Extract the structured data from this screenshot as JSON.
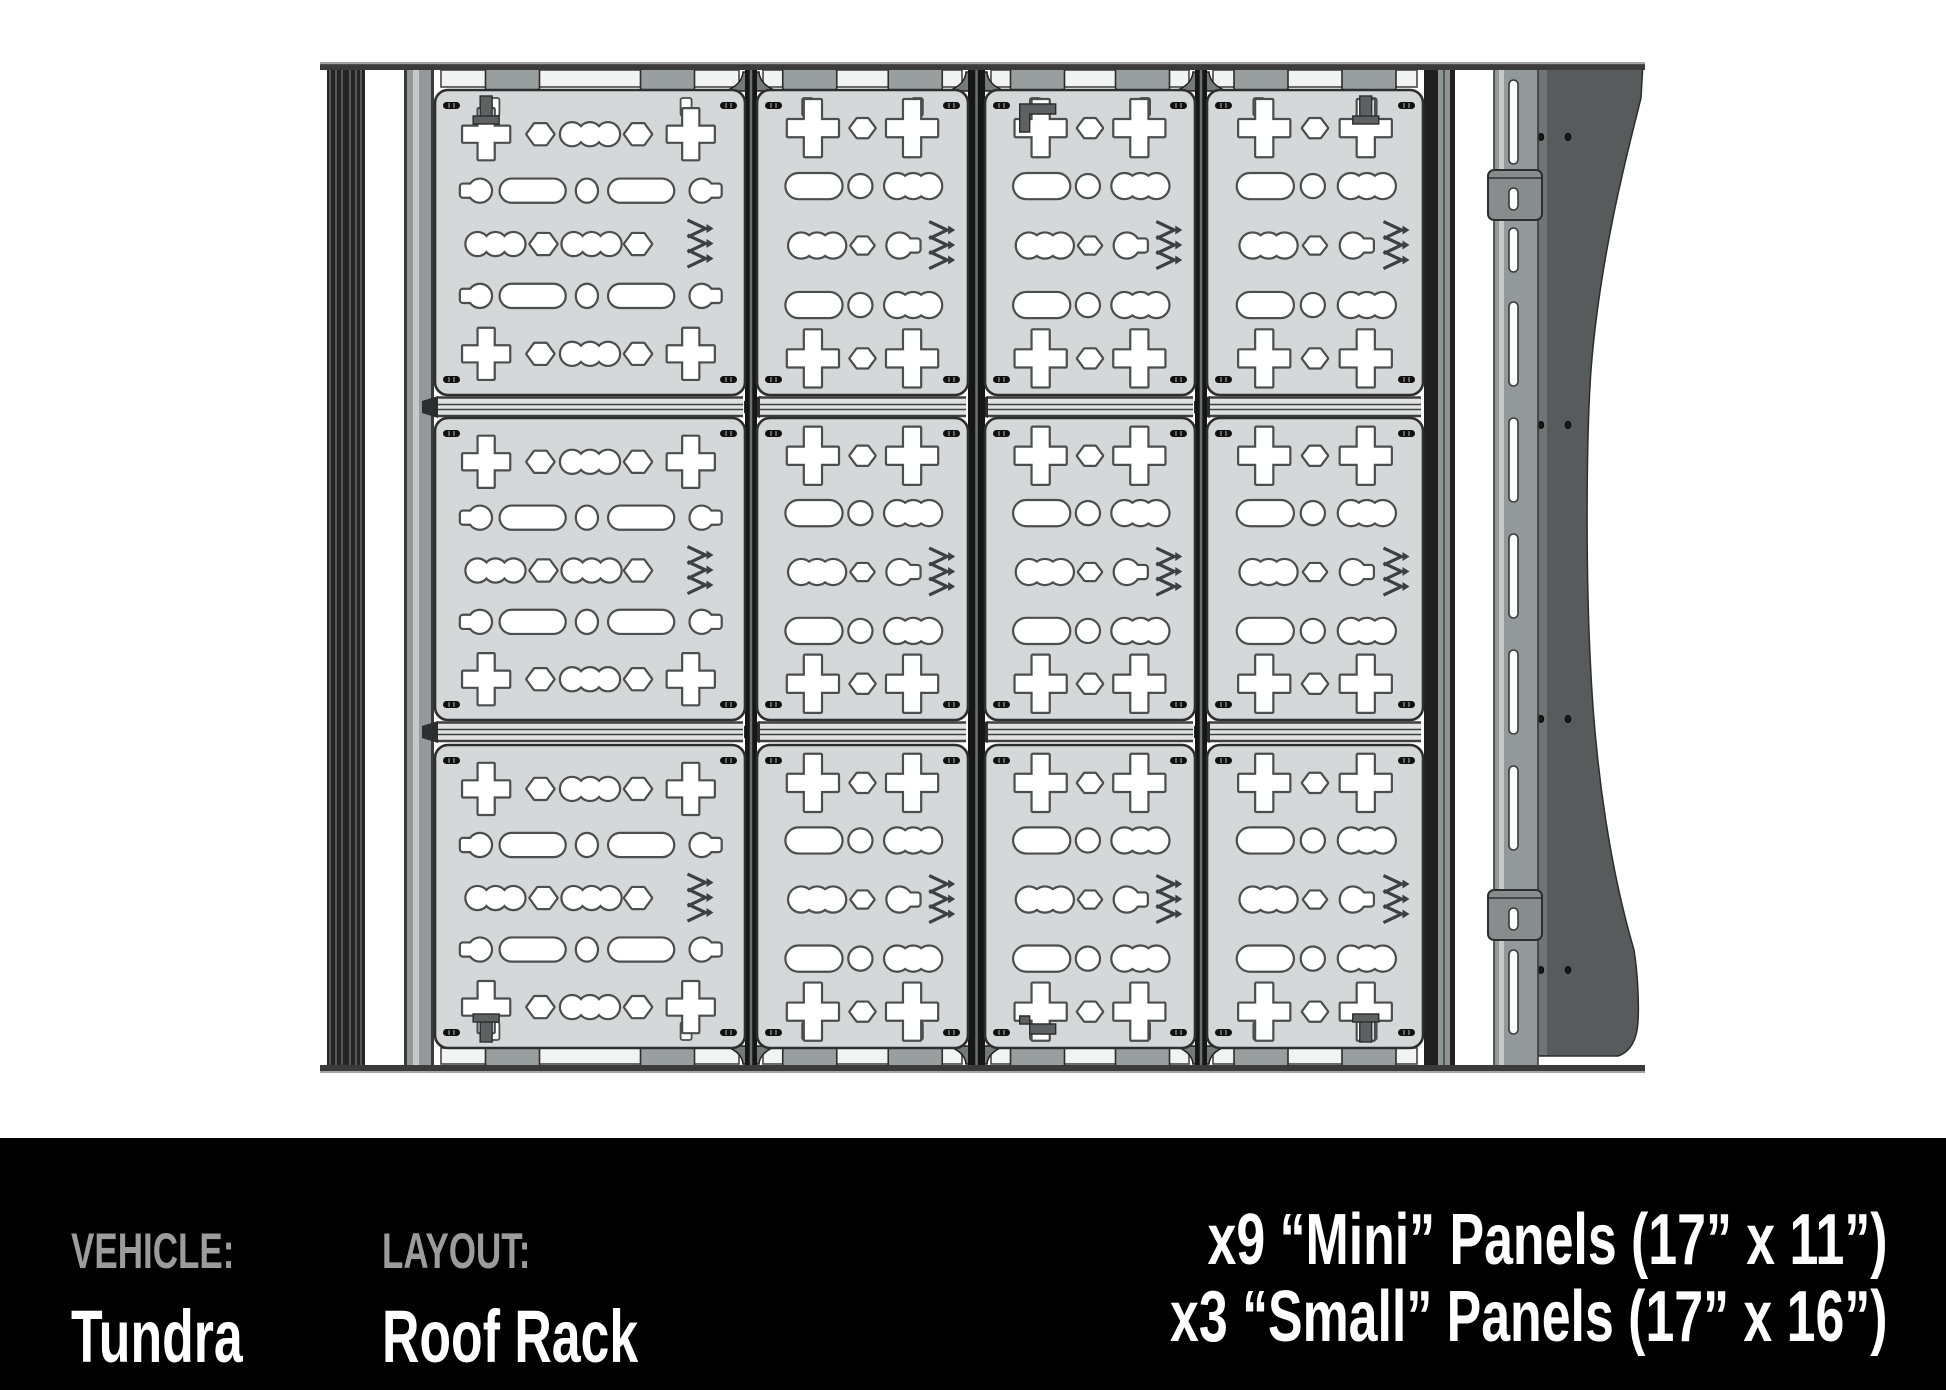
{
  "footer": {
    "vehicle_label": "VEHICLE:",
    "vehicle_value": "Tundra",
    "layout_label": "LAYOUT:",
    "layout_value": "Roof Rack",
    "count_line1": "x9 “Mini” Panels (17” x 11”)",
    "count_line2": "x3 “Small” Panels (17” x 16”)"
  },
  "diagram": {
    "name": "roof-rack-top-view-with-modular-panels",
    "panel_counts": {
      "mini": 9,
      "small": 3
    },
    "grid": {
      "columns": [
        {
          "type": "small",
          "x": 435,
          "w": 310
        },
        {
          "type": "mini",
          "x": 757,
          "w": 211
        },
        {
          "type": "mini",
          "x": 985,
          "w": 210
        },
        {
          "type": "mini",
          "x": 1207,
          "w": 216
        }
      ],
      "rows": [
        {
          "y": 90,
          "h": 305
        },
        {
          "y": 418,
          "h": 302
        },
        {
          "y": 745,
          "h": 303
        }
      ]
    },
    "hardware_marks": [
      {
        "r": 0,
        "c": 0,
        "kind": "tab",
        "edge": "top",
        "fx": 0.165
      },
      {
        "r": 0,
        "c": 2,
        "kind": "elbow",
        "edge": "top",
        "fx": 0.27
      },
      {
        "r": 0,
        "c": 3,
        "kind": "tab",
        "edge": "top",
        "fx": 0.735
      },
      {
        "r": 2,
        "c": 0,
        "kind": "tab",
        "edge": "bottom",
        "fx": 0.165
      },
      {
        "r": 2,
        "c": 2,
        "kind": "elbow",
        "edge": "bottom",
        "fx": 0.27
      },
      {
        "r": 2,
        "c": 3,
        "kind": "tab",
        "edge": "bottom",
        "fx": 0.735
      }
    ],
    "colors": {
      "panel": "#d5d8d9",
      "panel_outline": "#2e2e2e",
      "cutout": "#ffffff",
      "cutout_outline": "#4a4e4f",
      "frame_dark": "#161616",
      "rail_gray": "#93989a",
      "slat_light": "#f2f3f3",
      "band": "#e0e2e2",
      "fairing": "#575b5c",
      "bar": "#3b3b3b",
      "logo_ink": "#3c4041",
      "footer_bg": "#000000",
      "footer_label": "#9c9c9c",
      "footer_value": "#ffffff"
    }
  }
}
